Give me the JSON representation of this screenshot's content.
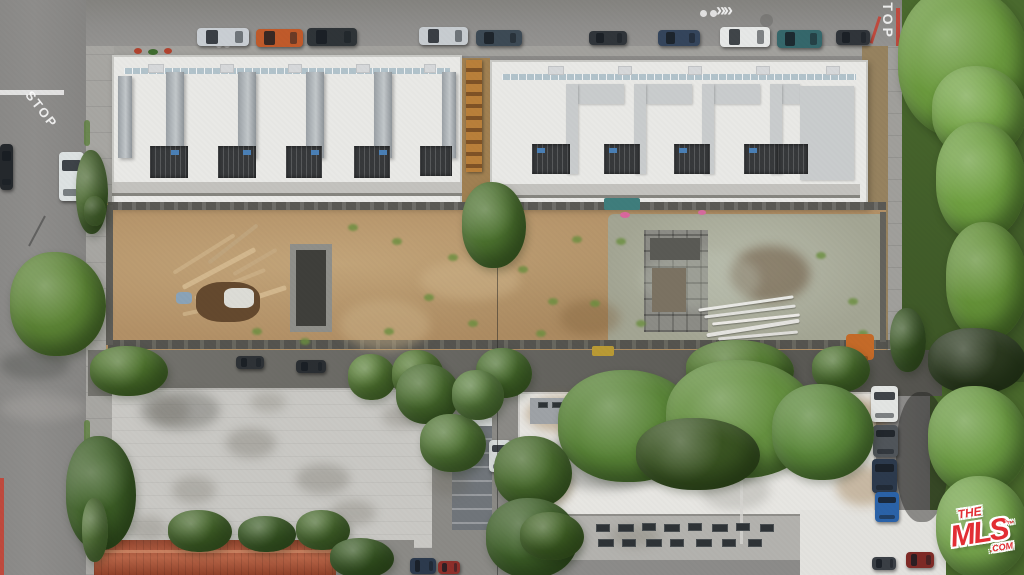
{
  "image": {
    "type": "aerial-drone-photo",
    "subject": "Top-down aerial photo of a construction site: two new white flat-roof townhome buildings along a street, a dirt/gravel construction lot behind them, existing apartment buildings with white and gray roofs below, tree-lined streets with parked cars",
    "width": 1024,
    "height": 575
  },
  "watermark": {
    "line1": "THE",
    "line2": "MLS",
    "tm": "™",
    "suffix": ".COM",
    "color": "#e22e34"
  },
  "road_markings": {
    "stop_left": "STOP",
    "stop_top": "STOP",
    "chevrons": "»»"
  },
  "palette": {
    "asphalt": "#8e8d8b",
    "asphalt-dark": "#7e7d7b",
    "sidewalk": "#a7a6a2",
    "roof-white": "#e9e9e6",
    "roof-white2": "#e7e6e2",
    "roof-trim": "#c9c9c5",
    "fin-gray": "#9aa0a5",
    "courtyard": "#37393b",
    "dirt": "#b29066",
    "gravel": "#a3a593",
    "tree": "#5d8536",
    "tree-dark": "#3c5526",
    "roof-gray": "#c9c8c4",
    "tile-red": "#a3503a",
    "mls-red": "#e22e34",
    "curb-red": "#bf4a3e",
    "alley": "#64635e"
  },
  "scene": {
    "_schemas": {
      "fins_caps_courts_hatches_bluedoors_skylights": "[x,y,w,h]",
      "stains": "[x,y,w,h,cssColor]",
      "sticks_pipes": "[x,y,w,h,color,rotDeg]",
      "weeds": "[x,y]",
      "props": "[x,y,w,h,color,rotDeg,opacity,borderRadius,name]",
      "vehicles": "[x,y,w,h,color,orientation h|v]",
      "trees": "[x,y,w,h,color]"
    },
    "fins": [
      [
        118,
        76,
        14,
        82
      ],
      [
        166,
        72,
        18,
        86
      ],
      [
        238,
        72,
        18,
        86
      ],
      [
        306,
        72,
        18,
        86
      ],
      [
        374,
        72,
        18,
        86
      ],
      [
        442,
        72,
        14,
        86
      ]
    ],
    "caps": [
      [
        578,
        84,
        46,
        20
      ],
      [
        646,
        84,
        46,
        20
      ],
      [
        714,
        84,
        46,
        20
      ],
      [
        782,
        84,
        18,
        20
      ],
      [
        800,
        86,
        54,
        94
      ],
      [
        566,
        84,
        12,
        90
      ],
      [
        634,
        84,
        12,
        90
      ],
      [
        702,
        84,
        12,
        90
      ],
      [
        770,
        84,
        12,
        90
      ]
    ],
    "courts": [
      [
        150,
        146,
        38,
        32
      ],
      [
        218,
        146,
        38,
        32
      ],
      [
        286,
        146,
        36,
        32
      ],
      [
        354,
        146,
        36,
        32
      ],
      [
        420,
        146,
        32,
        30
      ],
      [
        532,
        144,
        38,
        30
      ],
      [
        604,
        144,
        36,
        30
      ],
      [
        674,
        144,
        36,
        30
      ],
      [
        744,
        144,
        34,
        30
      ],
      [
        778,
        144,
        30,
        30
      ]
    ],
    "hatches": [
      [
        148,
        64,
        16,
        9
      ],
      [
        220,
        64,
        14,
        9
      ],
      [
        288,
        64,
        14,
        9
      ],
      [
        356,
        64,
        14,
        9
      ],
      [
        424,
        64,
        12,
        9
      ],
      [
        548,
        66,
        16,
        9
      ],
      [
        618,
        66,
        14,
        9
      ],
      [
        688,
        66,
        14,
        9
      ],
      [
        756,
        66,
        14,
        9
      ],
      [
        826,
        66,
        14,
        9
      ]
    ],
    "bluedoors": [
      [
        171,
        150,
        8,
        5
      ],
      [
        243,
        150,
        8,
        5
      ],
      [
        311,
        150,
        8,
        5
      ],
      [
        379,
        150,
        8,
        5
      ],
      [
        537,
        148,
        8,
        5
      ],
      [
        609,
        148,
        8,
        5
      ],
      [
        679,
        148,
        8,
        5
      ],
      [
        749,
        148,
        8,
        5
      ]
    ],
    "skylights": [
      [
        596,
        524,
        14,
        8
      ],
      [
        618,
        524,
        16,
        8
      ],
      [
        642,
        523,
        14,
        8
      ],
      [
        664,
        524,
        16,
        8
      ],
      [
        688,
        523,
        14,
        8
      ],
      [
        712,
        524,
        16,
        8
      ],
      [
        736,
        523,
        14,
        8
      ],
      [
        760,
        524,
        14,
        8
      ],
      [
        598,
        539,
        16,
        8
      ],
      [
        622,
        539,
        14,
        8
      ],
      [
        646,
        539,
        16,
        8
      ],
      [
        670,
        539,
        14,
        8
      ],
      [
        696,
        539,
        16,
        8
      ],
      [
        722,
        539,
        14,
        8
      ],
      [
        748,
        539,
        14,
        8
      ],
      [
        538,
        402,
        10,
        6
      ],
      [
        552,
        402,
        10,
        6
      ],
      [
        566,
        402,
        10,
        6
      ]
    ],
    "stains": [
      [
        140,
        390,
        80,
        40,
        "rgba(70,70,62,0.30)"
      ],
      [
        150,
        398,
        40,
        26,
        "rgba(95,90,78,0.28)"
      ],
      [
        226,
        428,
        50,
        30,
        "rgba(95,90,78,0.28)"
      ],
      [
        172,
        476,
        44,
        28,
        "rgba(95,90,78,0.25)"
      ],
      [
        296,
        464,
        54,
        30,
        "rgba(95,90,78,0.28)"
      ],
      [
        128,
        516,
        40,
        26,
        "rgba(95,90,78,0.25)"
      ],
      [
        382,
        404,
        40,
        24,
        "rgba(95,90,78,0.25)"
      ],
      [
        250,
        392,
        36,
        20,
        "rgba(95,90,78,0.22)"
      ],
      [
        330,
        500,
        46,
        26,
        "rgba(95,90,78,0.25)"
      ],
      [
        430,
        470,
        40,
        26,
        "rgba(95,90,78,0.22)"
      ],
      [
        526,
        396,
        70,
        36,
        "rgba(148,110,60,0.40)"
      ],
      [
        824,
        398,
        64,
        40,
        "rgba(148,110,60,0.42)"
      ],
      [
        516,
        462,
        56,
        44,
        "rgba(148,110,60,0.35)"
      ],
      [
        836,
        466,
        56,
        40,
        "rgba(148,110,60,0.38)"
      ],
      [
        700,
        470,
        70,
        40,
        "rgba(120,120,112,0.25)"
      ],
      [
        610,
        525,
        50,
        22,
        "rgba(120,115,100,0.30)"
      ],
      [
        730,
        246,
        80,
        56,
        "rgba(90,64,40,0.45)"
      ],
      [
        560,
        300,
        60,
        36,
        "rgba(125,95,58,0.35)"
      ],
      [
        420,
        260,
        100,
        40,
        "rgba(205,180,138,0.50)"
      ],
      [
        340,
        300,
        90,
        50,
        "rgba(205,180,138,0.45)"
      ],
      [
        640,
        250,
        120,
        60,
        "rgba(190,195,180,0.35)"
      ],
      [
        545,
        430,
        120,
        60,
        "rgba(40,42,38,0.28)"
      ],
      [
        0,
        350,
        70,
        30,
        "rgba(40,42,38,0.25)"
      ],
      [
        0,
        395,
        86,
        26,
        "rgba(200,198,192,0.22)"
      ]
    ],
    "sticks": [
      [
        168,
        252,
        72,
        4,
        "#c9ad83",
        -32
      ],
      [
        178,
        266,
        82,
        5,
        "#d2b78d",
        -28
      ],
      [
        192,
        282,
        76,
        4,
        "#c9ad83",
        -22
      ],
      [
        202,
        242,
        62,
        4,
        "#bfa47c",
        -38
      ],
      [
        216,
        296,
        72,
        5,
        "#d2b78d",
        -18
      ],
      [
        182,
        306,
        62,
        4,
        "#c9ad83",
        -12
      ],
      [
        230,
        260,
        50,
        4,
        "#c4a87f",
        -30
      ]
    ],
    "pipes": [
      [
        698,
        302,
        96,
        3,
        "#e9e9e5",
        -8
      ],
      [
        704,
        310,
        92,
        3,
        "#e2e2de",
        -7
      ],
      [
        712,
        318,
        88,
        3,
        "#eceae6",
        -6
      ],
      [
        706,
        326,
        94,
        4,
        "#e5e4e0",
        -9
      ],
      [
        718,
        334,
        80,
        3,
        "#dfdeda",
        -5
      ]
    ],
    "weeds": [
      [
        348,
        224
      ],
      [
        392,
        238
      ],
      [
        424,
        294
      ],
      [
        448,
        254
      ],
      [
        518,
        266
      ],
      [
        548,
        298
      ],
      [
        572,
        236
      ],
      [
        300,
        338
      ],
      [
        252,
        328
      ],
      [
        616,
        238
      ],
      [
        636,
        320
      ],
      [
        816,
        252
      ],
      [
        848,
        298
      ],
      [
        858,
        330
      ],
      [
        384,
        328
      ],
      [
        468,
        320
      ],
      [
        536,
        330
      ],
      [
        590,
        300
      ]
    ],
    "props": [
      [
        196,
        282,
        64,
        40,
        "#64492e",
        0,
        1,
        "40%",
        "debris-pile"
      ],
      [
        224,
        288,
        30,
        20,
        "#dcdcd6",
        0,
        1,
        "30%",
        "white-tarp"
      ],
      [
        176,
        292,
        16,
        12,
        "#8aa3b8",
        0,
        1,
        "30%",
        "blue-tarp"
      ],
      [
        604,
        198,
        36,
        12,
        "#3f7d7c",
        0,
        1,
        "2px",
        "teal-bin"
      ],
      [
        620,
        212,
        10,
        6,
        "#d9679d",
        0,
        1,
        "50%",
        "pink-marker"
      ],
      [
        698,
        210,
        8,
        5,
        "#d56a9e",
        0,
        1,
        "50%",
        "pink-marker"
      ],
      [
        846,
        334,
        28,
        26,
        "#c46a28",
        0,
        1,
        "4px",
        "orange-equipment"
      ],
      [
        858,
        356,
        10,
        20,
        "#9a5420",
        0,
        1,
        "2px",
        "equipment-arm"
      ],
      [
        592,
        346,
        22,
        10,
        "#b99a35",
        0,
        1,
        "2px",
        "yellow-equipment"
      ],
      [
        134,
        48,
        8,
        6,
        "#b0432f",
        0,
        1,
        "50%",
        "planting-strip-flower"
      ],
      [
        148,
        49,
        10,
        6,
        "#3f6b2f",
        0,
        1,
        "50%",
        "planting-strip-shrub"
      ],
      [
        164,
        48,
        8,
        6,
        "#b0432f",
        0,
        1,
        "50%",
        "planting-strip-flower"
      ],
      [
        652,
        268,
        34,
        44,
        "#7b7262",
        0,
        1,
        "0",
        "structure-tarp"
      ],
      [
        650,
        238,
        50,
        22,
        "#5a5a55",
        0,
        1,
        "0",
        "structure-cell"
      ],
      [
        216,
        42,
        6,
        6,
        "rgba(255,255,255,0.5)",
        0,
        1,
        "50%",
        "sharrow-dot"
      ],
      [
        224,
        42,
        6,
        6,
        "rgba(255,255,255,0.5)",
        0,
        1,
        "50%",
        "sharrow-dot"
      ],
      [
        700,
        10,
        7,
        7,
        "rgba(255,255,255,0.75)",
        0,
        1,
        "50%",
        "bike-marking-dot"
      ],
      [
        710,
        10,
        7,
        7,
        "rgba(255,255,255,0.75)",
        0,
        1,
        "50%",
        "bike-marking-dot"
      ],
      [
        760,
        14,
        13,
        13,
        "rgba(0,0,0,0.12)",
        0,
        1,
        "50%",
        "manhole-cover"
      ],
      [
        896,
        8,
        4,
        38,
        "#bf4a3e",
        0,
        1,
        "0",
        "red-curb"
      ],
      [
        874,
        16,
        3,
        28,
        "#bf4a3e",
        18,
        1,
        "0",
        "red-curb"
      ],
      [
        0,
        478,
        4,
        97,
        "#bf4a3e",
        0,
        1,
        "0",
        "red-curb"
      ],
      [
        36,
        214,
        2,
        34,
        "rgba(30,30,30,0.4)",
        28,
        1,
        "0",
        "pole-shadow"
      ],
      [
        96,
        550,
        238,
        3,
        "#cf8a68",
        0,
        0.8,
        "0",
        "tile-roof-ridge"
      ],
      [
        740,
        394,
        3,
        150,
        "#d4d3cf",
        0,
        0.8,
        "0",
        "roof-seam"
      ],
      [
        530,
        398,
        56,
        26,
        "#9ea2a6",
        0,
        1,
        "0",
        "roof-section-gray"
      ],
      [
        595,
        408,
        80,
        14,
        "#a9aaac",
        0,
        1,
        "0",
        "roof-section-gray"
      ],
      [
        452,
        418,
        40,
        8,
        "#d9dcdd",
        0,
        1,
        "0",
        "building-top-edge"
      ],
      [
        896,
        392,
        52,
        130,
        "rgba(30,32,28,0.45)",
        0,
        1,
        "45%",
        "tree-shadow"
      ],
      [
        0,
        90,
        64,
        5,
        "rgba(255,255,255,0.75)",
        0,
        1,
        "0",
        "crosswalk-line"
      ],
      [
        84,
        120,
        6,
        26,
        "#5c7f3d",
        0,
        0.8,
        "3px",
        "parkway-grass"
      ],
      [
        84,
        420,
        6,
        30,
        "#5c7f3d",
        0,
        0.8,
        "3px",
        "parkway-grass"
      ]
    ],
    "vehicles": [
      [
        197,
        28,
        52,
        18,
        "#c9ced3",
        "h"
      ],
      [
        256,
        29,
        47,
        18,
        "#c05a2a",
        "h"
      ],
      [
        307,
        28,
        50,
        18,
        "#2f3438",
        "h"
      ],
      [
        419,
        27,
        49,
        18,
        "#c7ccd0",
        "h"
      ],
      [
        476,
        30,
        46,
        16,
        "#3d4a55",
        "h"
      ],
      [
        589,
        31,
        38,
        14,
        "#30353a",
        "h"
      ],
      [
        658,
        30,
        42,
        16,
        "#34455c",
        "h"
      ],
      [
        720,
        27,
        50,
        20,
        "#e6e8e7",
        "h"
      ],
      [
        777,
        30,
        45,
        18,
        "#35676b",
        "h"
      ],
      [
        836,
        30,
        34,
        15,
        "#30353a",
        "h"
      ],
      [
        0,
        144,
        13,
        46,
        "#24282c",
        "v"
      ],
      [
        59,
        152,
        25,
        49,
        "#dde2e2",
        "v"
      ],
      [
        871,
        386,
        27,
        36,
        "#e3e5e3",
        "v"
      ],
      [
        873,
        425,
        25,
        32,
        "#50555a",
        "v"
      ],
      [
        872,
        459,
        25,
        34,
        "#2c3a4d",
        "v"
      ],
      [
        875,
        492,
        24,
        30,
        "#2a62a8",
        "v"
      ],
      [
        489,
        440,
        22,
        32,
        "#d8dcdb",
        "v"
      ],
      [
        410,
        558,
        26,
        16,
        "#2c3a4d",
        "h"
      ],
      [
        438,
        561,
        22,
        13,
        "#8e2f2a",
        "h"
      ],
      [
        906,
        552,
        28,
        16,
        "#7e2a26",
        "h"
      ],
      [
        872,
        557,
        24,
        13,
        "#3a3f45",
        "h"
      ],
      [
        236,
        356,
        28,
        13,
        "#2e3236",
        "h"
      ],
      [
        296,
        360,
        30,
        13,
        "#2a2e32",
        "h"
      ]
    ],
    "trees": [
      [
        76,
        150,
        32,
        84,
        "#4f6f33"
      ],
      [
        10,
        252,
        96,
        104,
        "#5d8536"
      ],
      [
        84,
        196,
        22,
        30,
        "#567a36"
      ],
      [
        462,
        182,
        64,
        86,
        "#4e7430"
      ],
      [
        90,
        346,
        78,
        50,
        "#51772f"
      ],
      [
        348,
        354,
        48,
        46,
        "#5d8439"
      ],
      [
        392,
        350,
        52,
        50,
        "#557b31"
      ],
      [
        476,
        348,
        56,
        50,
        "#4d7330"
      ],
      [
        686,
        340,
        108,
        60,
        "#567d33"
      ],
      [
        812,
        346,
        58,
        46,
        "#4f7530"
      ],
      [
        66,
        436,
        70,
        114,
        "#3f6128"
      ],
      [
        82,
        498,
        26,
        64,
        "#5c7f3d"
      ],
      [
        396,
        364,
        64,
        60,
        "#4c7030"
      ],
      [
        420,
        414,
        66,
        58,
        "#557a38"
      ],
      [
        452,
        370,
        52,
        50,
        "#5d8340"
      ],
      [
        558,
        370,
        142,
        112,
        "#5a8538"
      ],
      [
        666,
        360,
        152,
        118,
        "#659040"
      ],
      [
        772,
        384,
        102,
        96,
        "#5d8a3c"
      ],
      [
        636,
        418,
        124,
        72,
        "#3a5422"
      ],
      [
        494,
        436,
        78,
        72,
        "#4a6d2e"
      ],
      [
        486,
        498,
        92,
        80,
        "#40622a"
      ],
      [
        898,
        -14,
        132,
        152,
        "#6b9a3e"
      ],
      [
        932,
        66,
        94,
        92,
        "#76a648"
      ],
      [
        936,
        122,
        90,
        118,
        "#6fa041"
      ],
      [
        946,
        222,
        82,
        118,
        "#649138"
      ],
      [
        928,
        328,
        98,
        66,
        "#2c3a20"
      ],
      [
        928,
        386,
        100,
        108,
        "#6d9c44"
      ],
      [
        936,
        476,
        92,
        102,
        "#78a74e"
      ],
      [
        890,
        308,
        36,
        64,
        "#3e5c28"
      ],
      [
        168,
        510,
        64,
        42,
        "#486a2c"
      ],
      [
        238,
        516,
        58,
        36,
        "#41632a"
      ],
      [
        296,
        510,
        54,
        40,
        "#4d7031"
      ],
      [
        520,
        512,
        64,
        48,
        "#456728"
      ],
      [
        330,
        538,
        64,
        40,
        "#3c5d26"
      ]
    ]
  }
}
